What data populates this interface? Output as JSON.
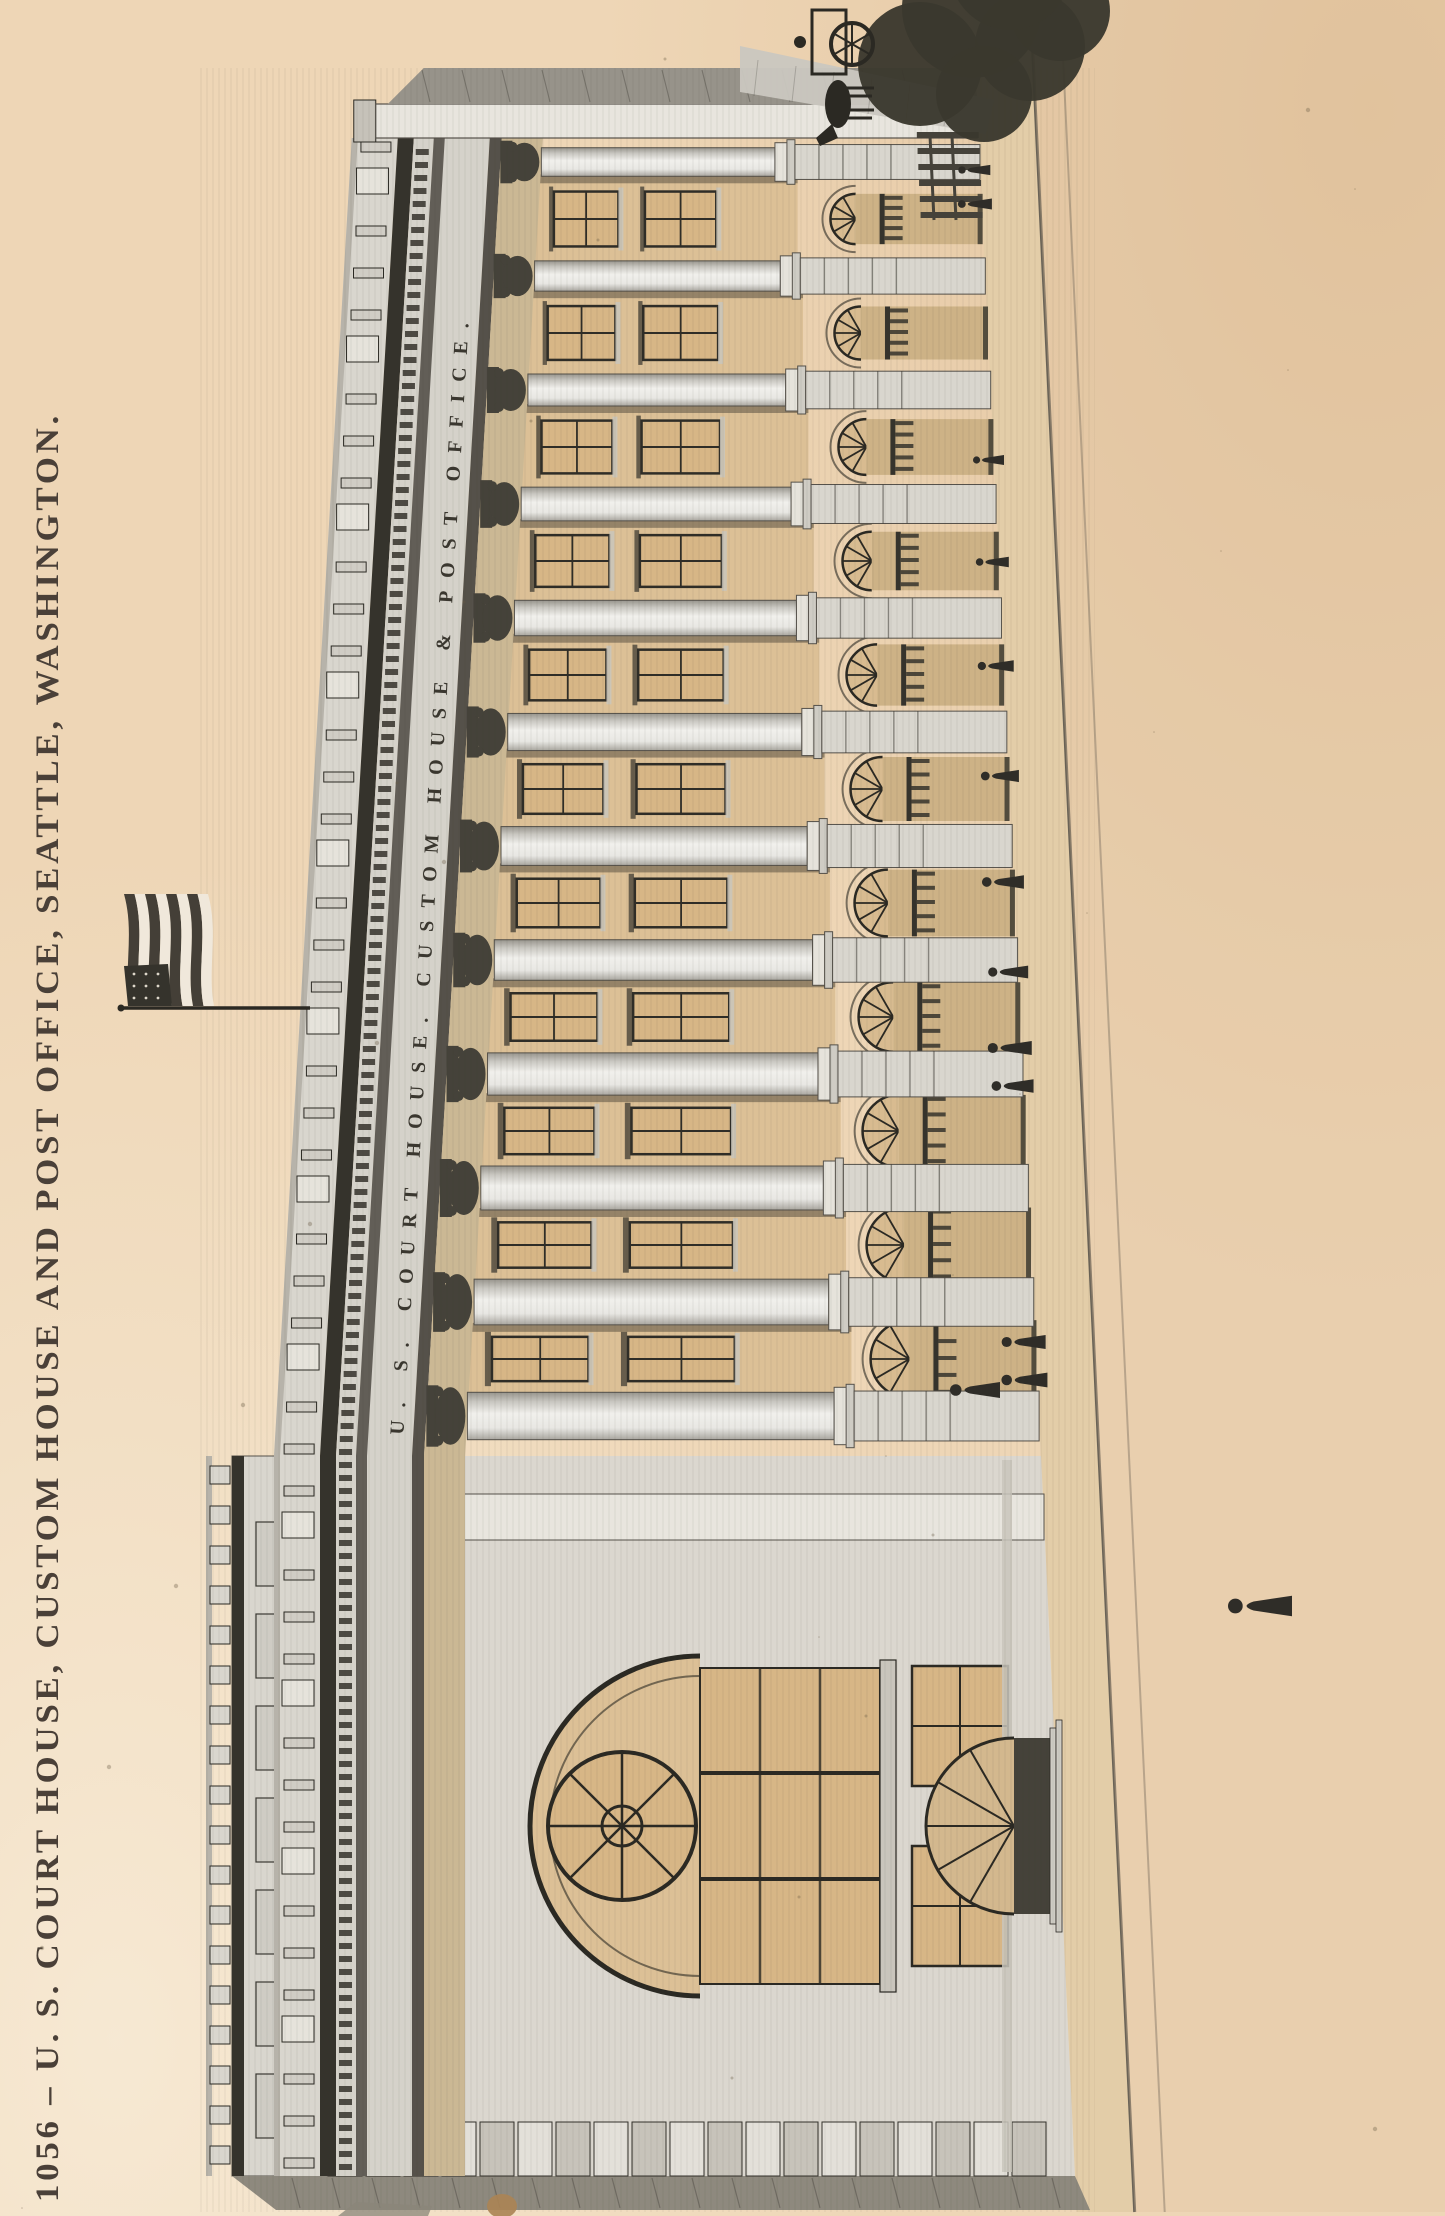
{
  "postcard": {
    "caption": "1056 – U. S. COURT HOUSE, CUSTOM HOUSE AND POST OFFICE, SEATTLE, WASHINGTON.",
    "frieze_inscription": "U. S. COURT HOUSE. CUSTOM HOUSE & POST OFFICE.",
    "colors": {
      "paper": "#eed6b6",
      "paper_light": "#f6e7cf",
      "paper_shade": "#dfc09a",
      "ink": "#2b2923",
      "stone": "#d9d6ce",
      "stone_bright": "#e8e5de",
      "stone_shadow": "#55514a",
      "frieze_light": "#d5d2ca",
      "cornice_dark": "#35332c",
      "wall_tan": "#dcc096",
      "window_tan": "#d7b686",
      "capital_dark": "#45423a",
      "street_gray": "#cac7c0",
      "sidewalk": "#e3cda8",
      "tree_dark": "#3a382e",
      "figure_dark": "#2f2d28",
      "caption_ink": "#4a4038"
    }
  }
}
